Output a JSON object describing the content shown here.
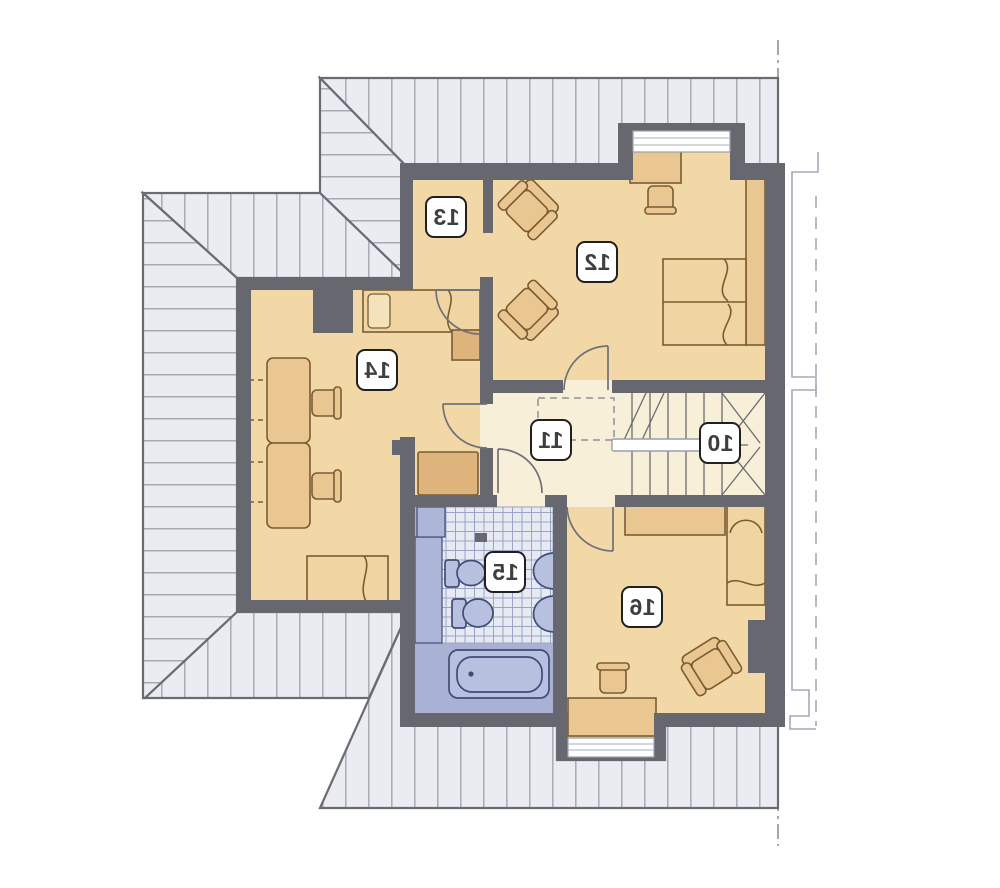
{
  "plan": {
    "room_labels": {
      "r10": "10",
      "r11": "11",
      "r12": "12",
      "r13": "13",
      "r14": "14",
      "r15": "15",
      "r16": "16"
    }
  },
  "colors": {
    "wall": "#67676f",
    "floor_tan": "#f2d8a6",
    "floor_hall": "#f8efd9",
    "bath_blue": "#a9b2d5",
    "roof_fill": "#eaecf1",
    "roof_line": "#a4abb7",
    "outline": "#6b6b74",
    "furn": "#eac791",
    "furn_light": "#f0d5a2",
    "furn_dark": "#dfb47c",
    "furn_line": "#7a5c33",
    "fix": "#b7c0de",
    "fix_line": "#404c78",
    "tile": "#e7eaf3",
    "tile_line": "#9ca5c4",
    "label_border": "#202020",
    "label_text": "#3f3f3f",
    "axis": "#8f8f97"
  }
}
